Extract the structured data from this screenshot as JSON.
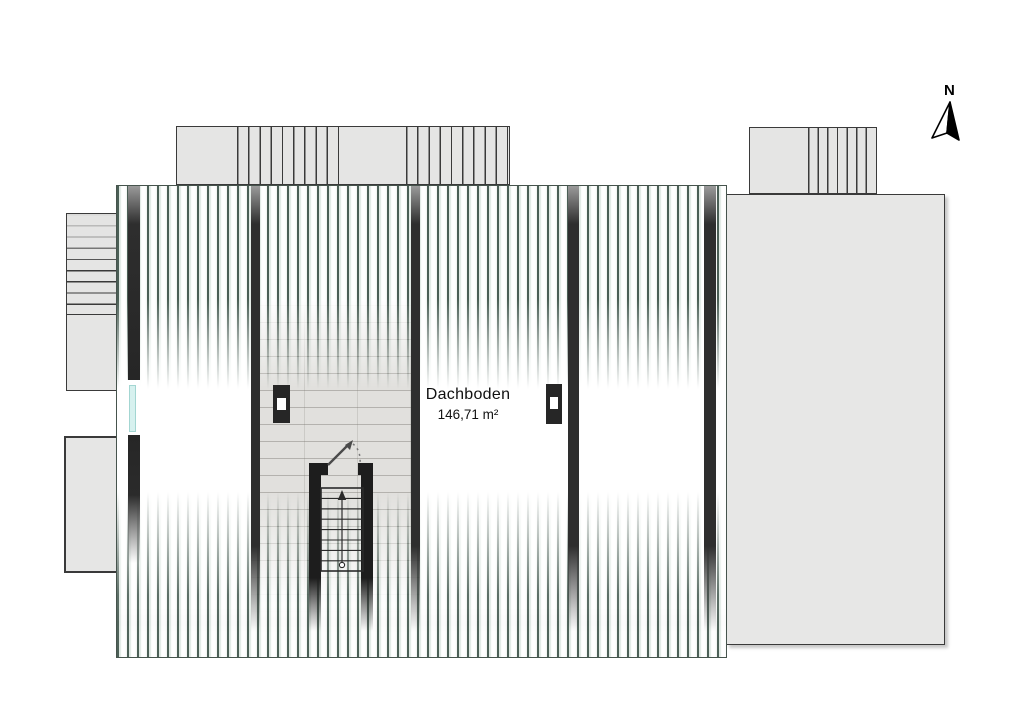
{
  "compass": {
    "label": "N"
  },
  "room": {
    "name": "Dachboden",
    "area": "146,71 m²"
  },
  "theme": {
    "hatch-dark": "#4b5f56",
    "annex-fill": "#e5e5e4",
    "annex-border": "#3a3a3a",
    "wall-dark": "#2e2e2e",
    "stair-wall": "#1d1d1d",
    "window-glass": "#d7f1ef",
    "texture-fill": "#e1e0dd",
    "chimney-fill": "#262626",
    "label-color": "#111111"
  }
}
